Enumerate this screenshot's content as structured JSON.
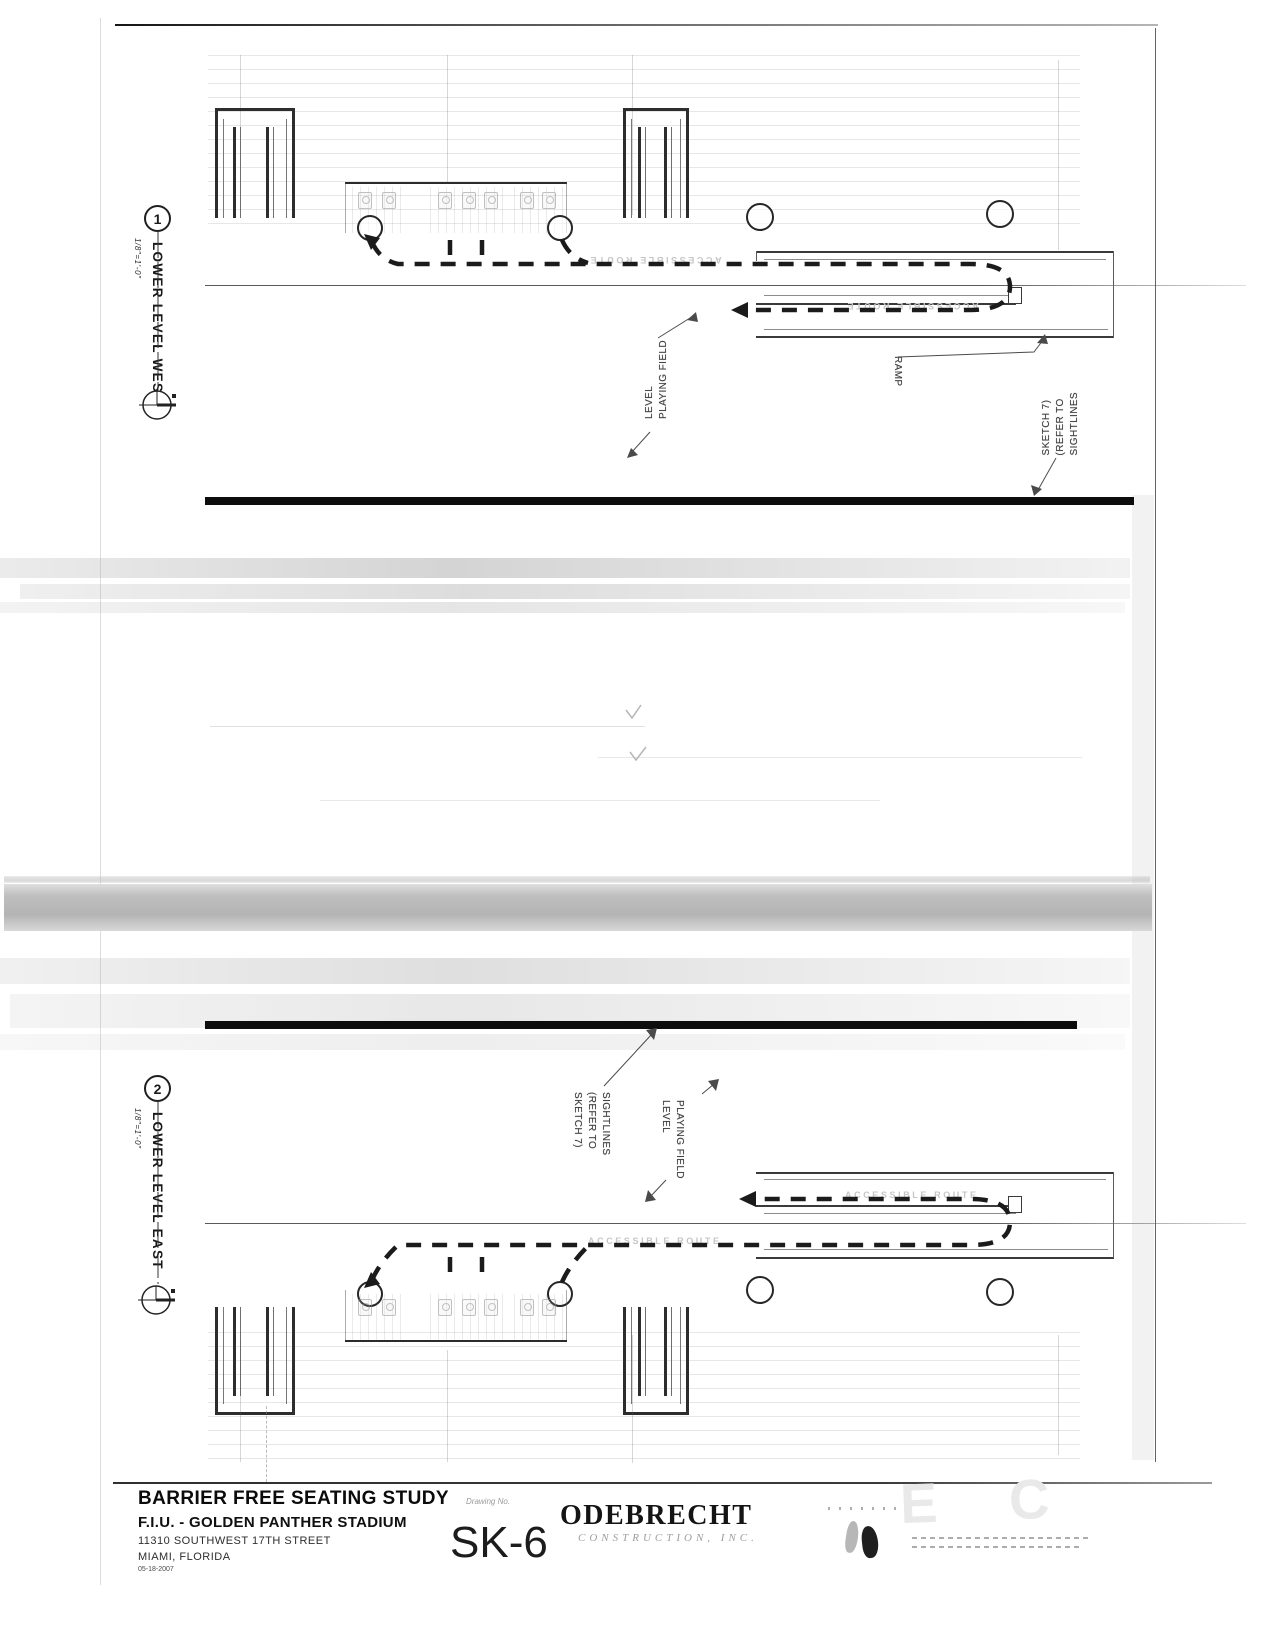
{
  "common": {
    "accessible_route_label": "ACCESSIBLE ROUTE",
    "ramp_label": "RAMP",
    "playing_field_lines": [
      "PLAYING FIELD",
      "LEVEL"
    ],
    "sightlines_lines": [
      "SIGHTLINES",
      "(REFER TO",
      "SKETCH 7)"
    ]
  },
  "details": {
    "d1": {
      "number": "1",
      "scale": "1/8\"=1'-0\"",
      "title": "LOWER LEVEL WEST"
    },
    "d2": {
      "number": "2",
      "scale": "1/8\"=1'-0\"",
      "title": "LOWER LEVEL EAST"
    }
  },
  "title_block": {
    "sheet_title": "BARRIER FREE SEATING STUDY",
    "project": "F.I.U. - GOLDEN PANTHER STADIUM",
    "address": "11310 SOUTHWEST 17TH STREET",
    "city": "MIAMI, FLORIDA",
    "date": "05-18-2007",
    "drawing_no_label": "Drawing No.",
    "drawing_no": "SK-6",
    "company": "ODEBRECHT",
    "company_subtitle": "CONSTRUCTION, INC."
  },
  "stamp": {
    "watermark": "E C"
  },
  "colors": {
    "ink": "#1a1a1a",
    "scan_band": "#b9b9b9",
    "faint_text": "#c6c6c6"
  }
}
